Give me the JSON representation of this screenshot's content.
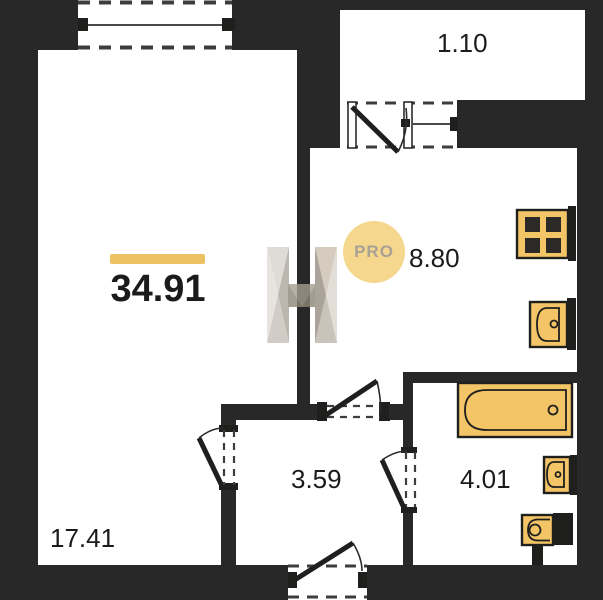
{
  "plan": {
    "total": {
      "area": "34.91"
    },
    "rooms": [
      {
        "id": "living-room",
        "area": "17.41"
      },
      {
        "id": "kitchen",
        "area": "8.80"
      },
      {
        "id": "hallway",
        "area": "3.59"
      },
      {
        "id": "bathroom",
        "area": "4.01"
      },
      {
        "id": "balcony",
        "area": "1.10"
      }
    ],
    "watermark": {
      "badge": "PRO"
    },
    "fixtures": [
      "stove-icon",
      "kitchen-sink-icon",
      "bathtub-icon",
      "washbasin-icon",
      "toilet-icon"
    ],
    "colors": {
      "wall": "#282828",
      "line": "#1f1f1e",
      "fixture": "#f4c566",
      "burner": "#2c2a26",
      "accent_bar": "#eec262",
      "pro_circle": "#f6d78e",
      "pro_text": "#a9a196",
      "dash": "#3d3d3d",
      "label": "#1b1b1b"
    }
  }
}
